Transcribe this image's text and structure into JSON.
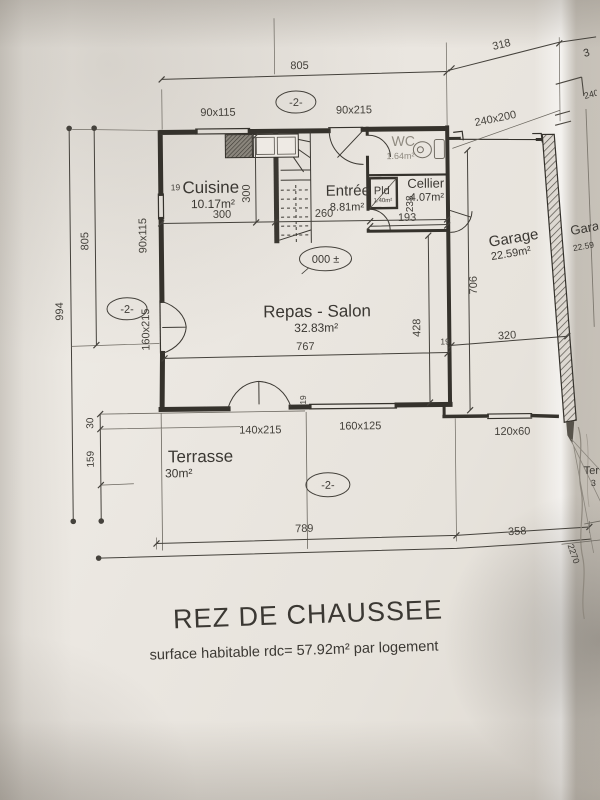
{
  "meta": {
    "plan_title": "REZ DE CHAUSSEE",
    "plan_subtitle": "surface habitable rdc= 57.92m² par logement"
  },
  "rooms": {
    "cuisine": {
      "name": "Cuisine",
      "area": "10.17m²"
    },
    "entree": {
      "name": "Entrée",
      "area": "8.81m²"
    },
    "wc": {
      "name": "WC",
      "area": "1.64m²"
    },
    "cellier": {
      "name": "Cellier",
      "area": "4.07m²"
    },
    "placard": {
      "name": "Pld",
      "area": "1.40m²"
    },
    "garage": {
      "name": "Garage",
      "area": "22.59m²"
    },
    "salon": {
      "name": "Repas - Salon",
      "area": "32.83m²"
    },
    "terrasse": {
      "name": "Terrasse",
      "area": "30m²"
    }
  },
  "markers": {
    "level_zero": "000 ±",
    "level_minus2_top": "-2-",
    "level_minus2_left": "-2-",
    "level_minus2_bottom": "-2-"
  },
  "dims": {
    "top_805": "805",
    "top_318": "318",
    "left_805": "805",
    "left_994": "994",
    "left_30": "30",
    "left_159": "159",
    "bottom_789": "789",
    "bottom_358": "358",
    "cuisine_w": "300",
    "cuisine_h": "300",
    "entree_w": "260",
    "cellier_w": "193",
    "cellier_h": "238",
    "garage_h": "706",
    "garage_w": "320",
    "salon_w": "767",
    "salon_h": "428",
    "wall_19_cuisine": "19",
    "wall_19_salon": "19",
    "wall_19_garage": "19"
  },
  "openings": {
    "window_top": "90x115",
    "door_entry": "90x215",
    "window_left_kitchen": "90x115",
    "window_left_salon": "160x215",
    "door_terrace": "140x215",
    "window_bottom": "160x125",
    "window_garage": "120x60",
    "door_garage": "240x200"
  },
  "adjacent": {
    "garage_name": "Gara",
    "garage_area": "22.59",
    "terrasse_name": "Ter",
    "terrasse_area": "3",
    "fold_dim": "2270",
    "top_dim": "3",
    "garage_door_dim": "240"
  },
  "colors": {
    "ink": "#35322c",
    "dim_ink": "#45423c",
    "paper": "#eae6e0"
  }
}
